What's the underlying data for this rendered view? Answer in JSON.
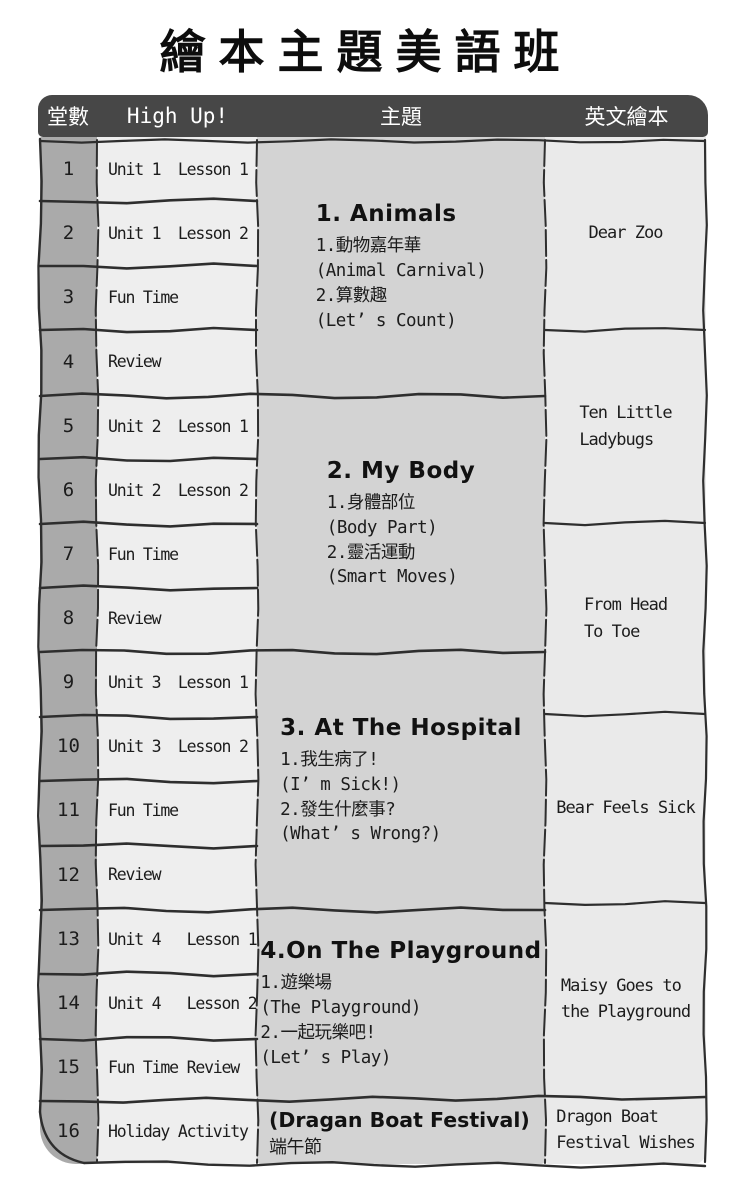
{
  "title": "繪本主題美語班",
  "header": {
    "col_lesson_no": "堂數",
    "col_curriculum": "High Up!",
    "col_theme": "主題",
    "col_book": "英文繪本"
  },
  "rows": [
    {
      "num": "1",
      "lesson": "Unit 1  Lesson 1"
    },
    {
      "num": "2",
      "lesson": "Unit 1  Lesson 2"
    },
    {
      "num": "3",
      "lesson": "Fun Time"
    },
    {
      "num": "4",
      "lesson": "Review"
    },
    {
      "num": "5",
      "lesson": "Unit 2  Lesson 1"
    },
    {
      "num": "6",
      "lesson": "Unit 2  Lesson 2"
    },
    {
      "num": "7",
      "lesson": "Fun Time"
    },
    {
      "num": "8",
      "lesson": "Review"
    },
    {
      "num": "9",
      "lesson": "Unit 3  Lesson 1"
    },
    {
      "num": "10",
      "lesson": "Unit 3  Lesson 2"
    },
    {
      "num": "11",
      "lesson": "Fun Time"
    },
    {
      "num": "12",
      "lesson": "Review"
    },
    {
      "num": "13",
      "lesson": "Unit 4   Lesson 1"
    },
    {
      "num": "14",
      "lesson": "Unit 4   Lesson 2"
    },
    {
      "num": "15",
      "lesson": "Fun Time Review"
    },
    {
      "num": "16",
      "lesson": "Holiday Activity"
    }
  ],
  "themes": [
    {
      "heading": "1. Animals",
      "lines": "1.動物嘉年華\n(Animal Carnival)\n2.算數趣\n(Let’ s Count)"
    },
    {
      "heading": "2. My Body",
      "lines": "1.身體部位\n(Body Part)\n2.靈活運動\n(Smart Moves)"
    },
    {
      "heading": "3. At The Hospital",
      "lines": "1.我生病了!\n(I’ m Sick!)\n2.發生什麼事?\n(What’ s Wrong?)"
    },
    {
      "heading": "4.On The Playground",
      "lines": "1.遊樂場\n(The Playground)\n2.一起玩樂吧!\n(Let’ s Play)"
    },
    {
      "heading": "(Dragan Boat Festival)",
      "lines": "端午節"
    }
  ],
  "books": [
    {
      "title": "Dear Zoo"
    },
    {
      "title": "Ten Little\nLadybugs"
    },
    {
      "title": "From Head\nTo Toe"
    },
    {
      "title": "Bear Feels Sick"
    },
    {
      "title": "Maisy Goes to\nthe Playground"
    },
    {
      "title": "Dragon Boat\nFestival Wishes"
    }
  ],
  "colors": {
    "page_bg": "#ffffff",
    "header_bg": "#474747",
    "header_text": "#ffffff",
    "col_lesson_no_bg": "#aaaaaa",
    "col_curriculum_bg": "#eeeeee",
    "col_theme_bg": "#d3d3d3",
    "col_book_bg": "#eaeaea",
    "line": "#2e2e2e",
    "text": "#1c1c1c"
  }
}
